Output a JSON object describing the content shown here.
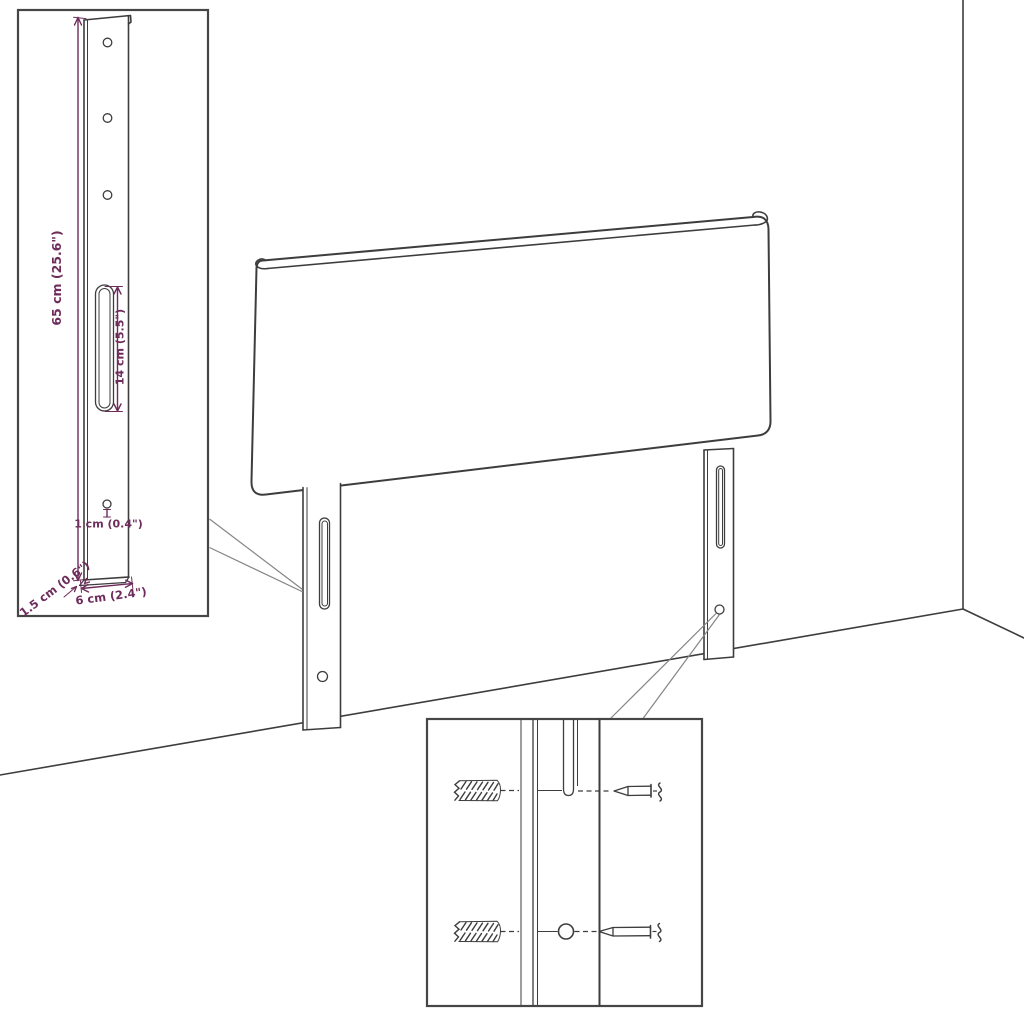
{
  "colors": {
    "background": "#ffffff",
    "line": "#3d3d3d",
    "dimension": "#6e2c5b",
    "callout": "#858585",
    "inset_border": "#464646"
  },
  "leg_detail_inset": {
    "dimensions": {
      "height": "65 cm (25.6\")",
      "slot_length": "14 cm (5.5\")",
      "hole": "1 cm (0.4\")",
      "thickness": "1.5 cm (0.6\")",
      "width": "6 cm (2.4\")"
    }
  }
}
